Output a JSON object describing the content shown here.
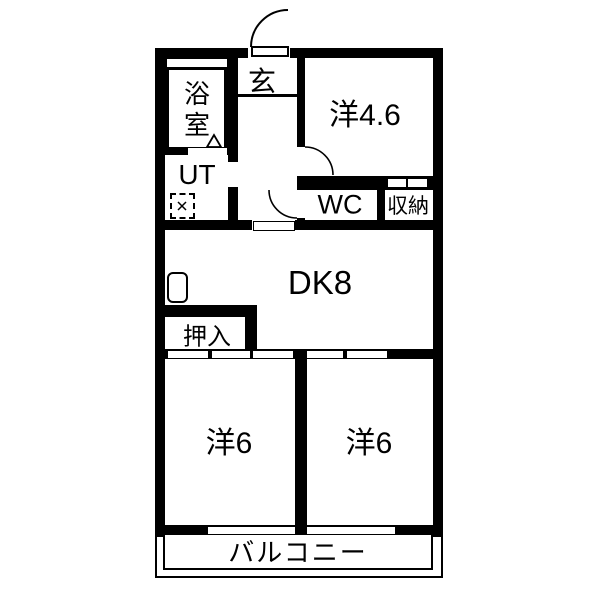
{
  "plan": {
    "type": "japanese-apartment-floorplan",
    "colors": {
      "wall": "#000000",
      "floor": "#ffffff"
    },
    "rooms": {
      "entrance": {
        "label": "玄"
      },
      "bathroom": {
        "label": "浴室",
        "line1": "浴",
        "line2": "室"
      },
      "utility": {
        "label": "UT"
      },
      "western_room_46": {
        "label": "洋4.6"
      },
      "toilet": {
        "label": "WC"
      },
      "storage": {
        "label": "収納"
      },
      "dining_kitchen": {
        "label": "DK8"
      },
      "closet": {
        "label": "押入"
      },
      "western_room_6_left": {
        "label": "洋6"
      },
      "western_room_6_right": {
        "label": "洋6"
      },
      "balcony": {
        "label": "バルコニー"
      }
    }
  }
}
